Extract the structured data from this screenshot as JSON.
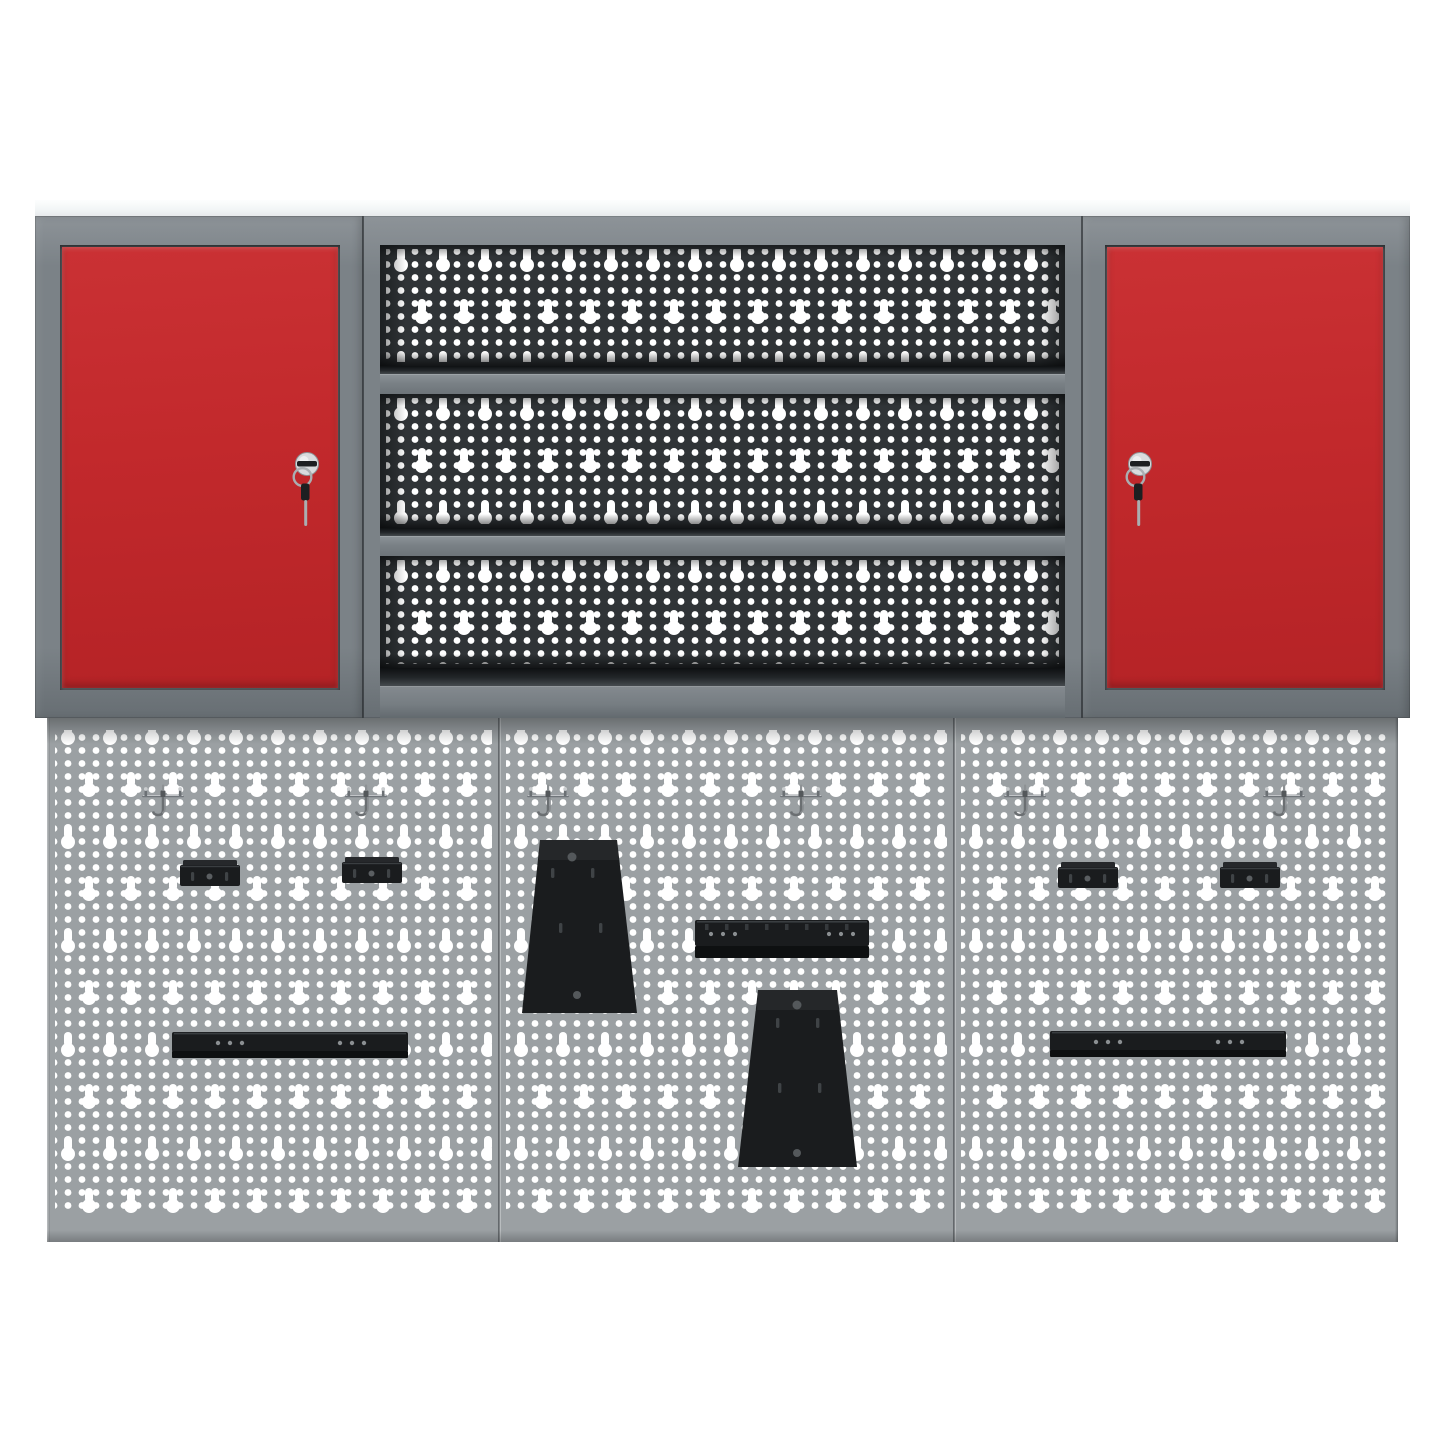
{
  "scene": {
    "subject": "garage workshop wall set: two red-door lockable wall cabinets, open shelf unit with perforated back panel, and three-panel perforated pegboard wall with mounted black steel accessories",
    "background_color": "#ffffff"
  },
  "colors": {
    "bg": "#ffffff",
    "top_strip": "#f2f5f6",
    "frame": "#7b8287",
    "frame_light": "#8d9398",
    "frame_dark": "#676e73",
    "red": "#c2292c",
    "red_dark": "#a81f22",
    "panel_dark": "#303437",
    "peg": "#9ba0a3",
    "hole": "#ffffff",
    "black": "#1a1c1e",
    "black_deep": "#0e1011",
    "rivet": "#8b8f92",
    "slot": "#3f4346",
    "silver": "#d9dbdd",
    "silver_mid": "#aaaeb1",
    "silver_dark": "#70757a",
    "key_black": "#1d1f21"
  },
  "parts": {
    "cabinets": {
      "count": 2,
      "door_color": "#c2292c",
      "locks_with_hanging_keys": 2
    },
    "shelf_unit": {
      "openings": 3,
      "shelf_boards": 2,
      "perforated_back_color": "#303437"
    },
    "pegboard_wall": {
      "panels": 3,
      "double_hooks": 6,
      "hook_brackets": 4,
      "tool_rails": 3,
      "trapezoid_mounting_plates": 2
    }
  }
}
